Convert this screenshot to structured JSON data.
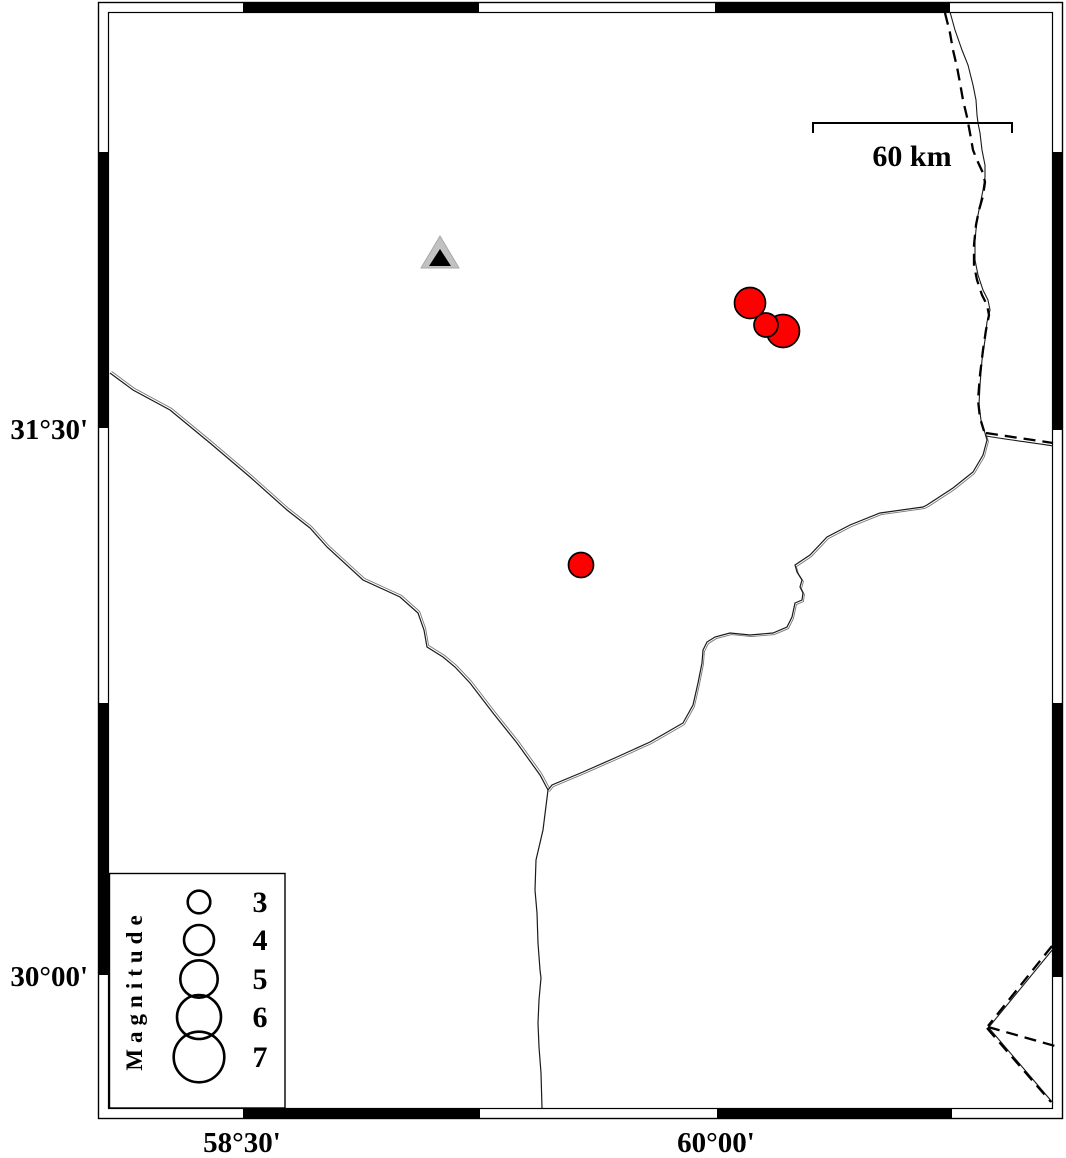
{
  "map": {
    "type": "seismicity-map",
    "axis": {
      "lat_labels": [
        {
          "text": "31°30'",
          "y": 428
        },
        {
          "text": "30°00'",
          "y": 975
        }
      ],
      "lon_labels": [
        {
          "text": "58°30'",
          "x": 242
        },
        {
          "text": "60°00'",
          "x": 716
        }
      ]
    },
    "scale_bar": {
      "label": "60 km",
      "x1": 813,
      "x2": 1012,
      "y": 123,
      "tick_drop": 10,
      "label_x": 912,
      "label_y": 166
    },
    "legend": {
      "title": "Magnitude",
      "circle_cx": 199,
      "num_x": 260,
      "entries": [
        {
          "label": "3",
          "cy": 902,
          "radius": 11.3
        },
        {
          "label": "4",
          "cy": 940,
          "radius": 15.0
        },
        {
          "label": "5",
          "cy": 979,
          "radius": 18.7
        },
        {
          "label": "6",
          "cy": 1017,
          "radius": 22.0
        },
        {
          "label": "7",
          "cy": 1057,
          "radius": 25.3
        }
      ]
    },
    "markers": {
      "earthquakes": [
        {
          "x": 783,
          "y": 331,
          "r": 16.5
        },
        {
          "x": 766,
          "y": 325,
          "r": 12.0
        },
        {
          "x": 750,
          "y": 303,
          "r": 15.5
        },
        {
          "x": 581,
          "y": 565,
          "r": 12.5
        }
      ],
      "station": {
        "x": 440,
        "y": 253
      }
    },
    "colors": {
      "earthquake_fill": "#ff0000",
      "marker_outline": "#000000",
      "station_gray": "#c2c2c2",
      "station_core": "#000000",
      "line": "#1a1a1a"
    }
  }
}
